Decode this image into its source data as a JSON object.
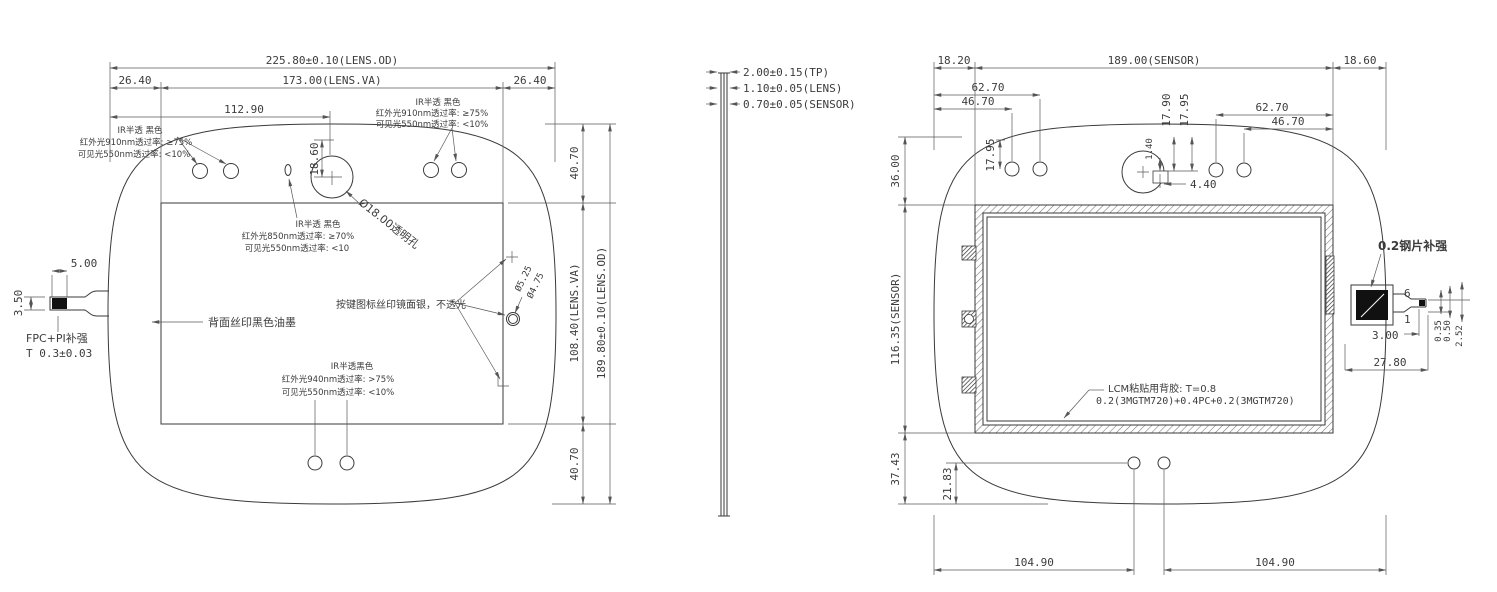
{
  "left_view": {
    "dims": {
      "od_w": "225.80±0.10(LENS.OD)",
      "margin_l": "26.40",
      "va_w": "173.00(LENS.VA)",
      "margin_r": "26.40",
      "hole_off_x": "112.90",
      "hole_off_y": "18.60",
      "margin_t": "40.70",
      "va_h": "108.40(LENS.VA)",
      "od_h": "189.80±0.10(LENS.OD)",
      "margin_b": "40.70",
      "fpc_tail_h": "3.50",
      "fpc_tail_w": "5.00",
      "btn_od": "Ø5.25",
      "btn_id": "Ø4.75"
    },
    "labels": {
      "fpc_stiffener": "FPC+PI补强",
      "fpc_thickness": "T 0.3±0.03",
      "back_ink": "背面丝印黑色油墨",
      "ir_hole": "Ø18.00透明孔",
      "button_print": "按键图标丝印镜面银，不透光"
    },
    "note_tl": [
      "IR半透 黑色",
      "红外光910nm透过率: ≥75%",
      "可见光550nm透过率: <10%"
    ],
    "note_tr": [
      "IR半透 黑色",
      "红外光910nm透过率: ≥75%",
      "可见光550nm透过率: <10%"
    ],
    "note_center": [
      "IR半透 黑色",
      "红外光850nm透过率: ≥70%",
      "可见光550nm透过率: <10"
    ],
    "note_bottom": [
      "IR半透黑色",
      "红外光940nm透过率: >75%",
      "可见光550nm透过率: <10%"
    ]
  },
  "side_view": {
    "tp": "2.00±0.15(TP)",
    "lens": "1.10±0.05(LENS)",
    "sensor": "0.70±0.05(SENSOR)"
  },
  "right_view": {
    "dims": {
      "margin_l": "18.20",
      "sensor_w": "189.00(SENSOR)",
      "margin_r": "18.60",
      "d6270_l": "62.70",
      "d4670_l": "46.70",
      "d1795_l": "17.95",
      "d1790": "17.90",
      "d1795_c": "17.95",
      "d140": "1.40",
      "d440": "4.40",
      "d6270_r": "62.70",
      "d4670_r": "46.70",
      "d3600": "36.00",
      "sensor_h": "116.35(SENSOR)",
      "d3743": "37.43",
      "d2183": "21.83",
      "d10490_l": "104.90",
      "d10490_r": "104.90",
      "d300": "3.00",
      "d035": "0.35",
      "d050": "0.50",
      "d252": "2.52",
      "d2780": "27.80",
      "pin6": "6",
      "pin1": "1"
    },
    "labels": {
      "steel": "0.2钢片补强",
      "lcm1": "LCM粘贴用背胶: T=0.8",
      "lcm2": "0.2(3MGTM720)+0.4PC+0.2(3MGTM720)"
    }
  }
}
